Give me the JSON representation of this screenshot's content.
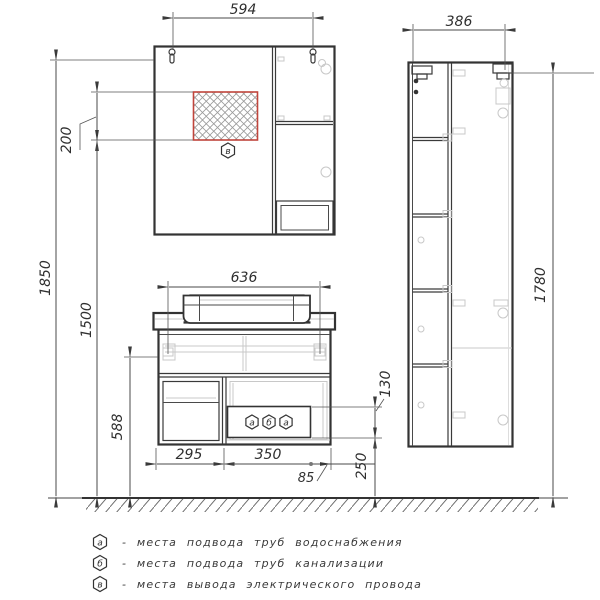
{
  "drawing": {
    "type": "furniture installation technical drawing",
    "colors": {
      "line": "#3a3a3a",
      "light_line": "#c8c8c8",
      "accent_red": "#c0453c",
      "text": "#2f2f2f"
    }
  },
  "dims": {
    "mirror_mount_width": "594",
    "tall_cabinet_width": "386",
    "vanity_top_width": "636",
    "mirror_top_height": "1850",
    "outlet_bottom_height": "1500",
    "outlet_zone_height": "200",
    "vanity_mount_height": "588",
    "tall_cabinet_mount_height": "1780",
    "service_panel_height": "130",
    "service_panel_bottom_height": "250",
    "left_section_width": "295",
    "service_panel_width": "350",
    "service_panel_offset": "85"
  },
  "markers": {
    "mirror": "в",
    "vanity": [
      "а",
      "б",
      "а"
    ]
  },
  "legend": {
    "items": [
      {
        "symbol": "а",
        "text": "-  места подвода труб водоснабжения"
      },
      {
        "symbol": "б",
        "text": "-  места подвода труб канализации"
      },
      {
        "symbol": "в",
        "text": "-  места вывода электрического провода"
      }
    ]
  }
}
